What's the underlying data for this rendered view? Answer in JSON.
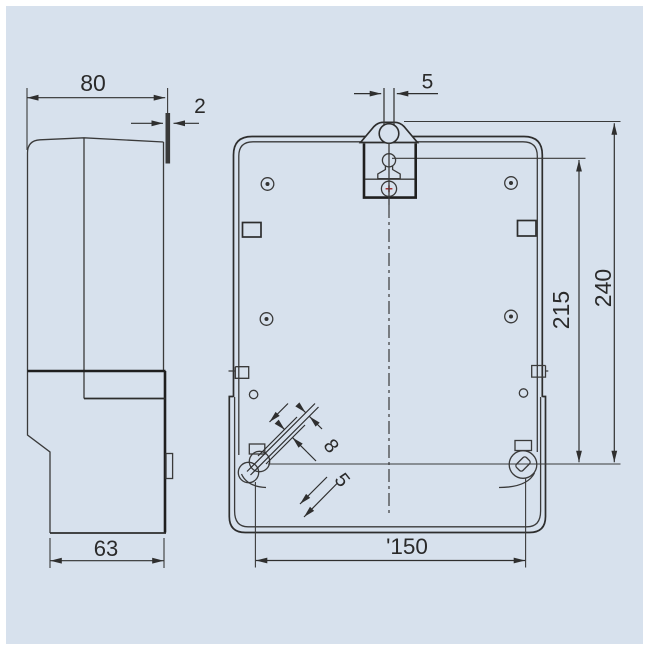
{
  "drawing": {
    "type": "technical-drawing",
    "subject": "meter-case-outline-two-views",
    "background_color": "#d7e1ed",
    "line_color": "#2f2f2f",
    "screw_accent_color": "#a03434",
    "views": {
      "side": {
        "name": "side-profile-view"
      },
      "front": {
        "name": "rear-mounting-view"
      }
    },
    "dimensions": {
      "side_width": "80",
      "hanger_thickness": "2",
      "side_base_width": "63",
      "hanger_slot_width": "5",
      "overall_height": "240",
      "hang_to_mount_height": "215",
      "mount_hole_spacing": "'150",
      "mount_slot_length": "8",
      "mount_slot_width": "5"
    }
  }
}
